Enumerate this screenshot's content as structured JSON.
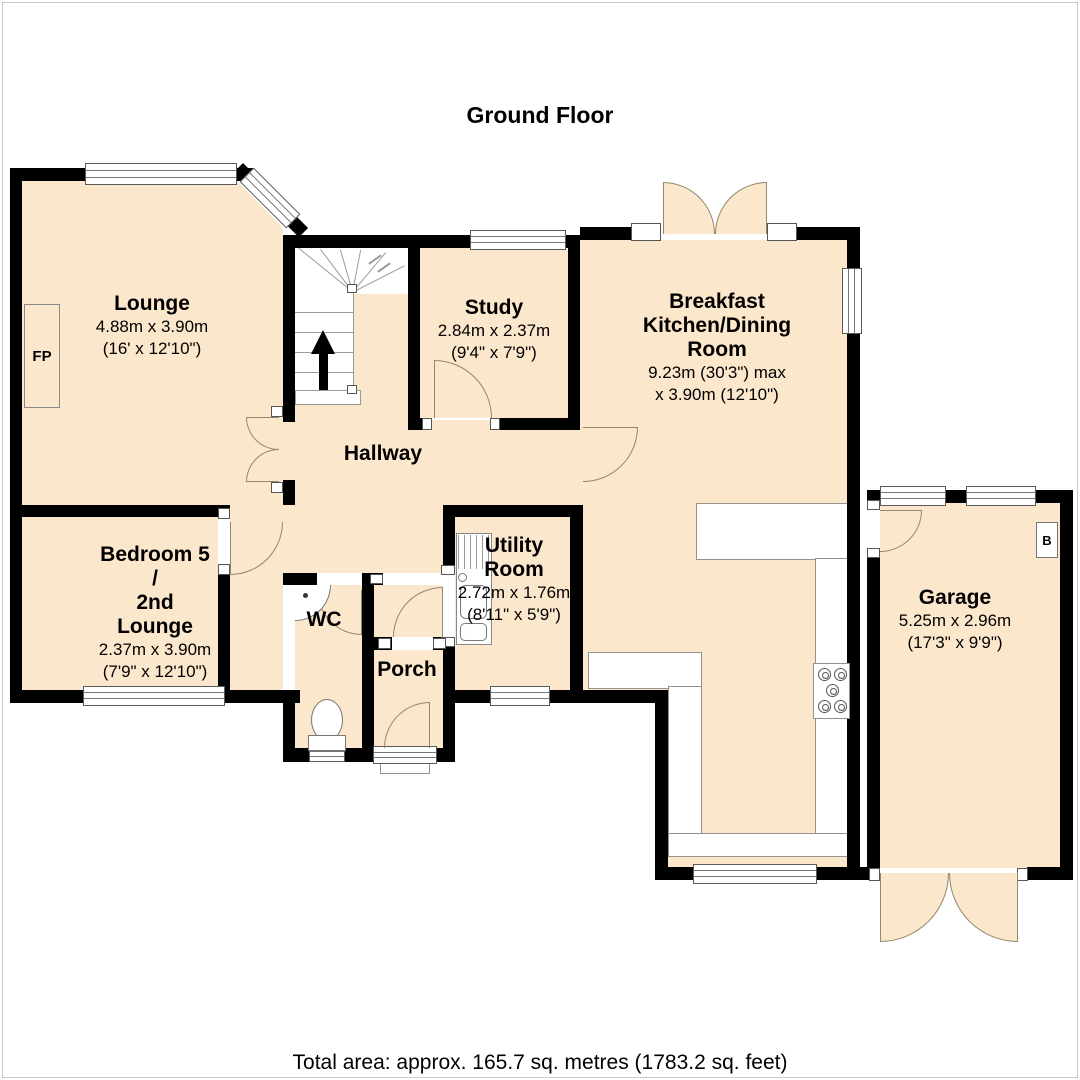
{
  "title": "Ground Floor",
  "footer": "Total area: approx. 165.7 sq. metres (1783.2 sq. feet)",
  "rooms": {
    "lounge": {
      "name": "Lounge",
      "dim_m": "4.88m x 3.90m",
      "dim_ft": "(16' x 12'10\")"
    },
    "study": {
      "name": "Study",
      "dim_m": "2.84m x 2.37m",
      "dim_ft": "(9'4\" x 7'9\")"
    },
    "kitchen": {
      "line1": "Breakfast",
      "line2": "Kitchen/Dining",
      "line3": "Room",
      "dim1": "9.23m (30'3\") max",
      "dim2": "x 3.90m (12'10\")"
    },
    "hallway": {
      "name": "Hallway"
    },
    "bedroom5": {
      "line1": "Bedroom 5",
      "line2": "/",
      "line3": "2nd",
      "line4": "Lounge",
      "dim_m": "2.37m x 3.90m",
      "dim_ft": "(7'9\" x 12'10\")"
    },
    "wc": {
      "name": "WC"
    },
    "porch": {
      "name": "Porch"
    },
    "utility": {
      "line1": "Utility",
      "line2": "Room",
      "dim_m": "2.72m x 1.76m",
      "dim_ft": "(8'11\" x 5'9\")"
    },
    "garage": {
      "name": "Garage",
      "dim_m": "5.25m x 2.96m",
      "dim_ft": "(17'3\" x 9'9\")"
    }
  },
  "markers": {
    "fireplace": "FP",
    "boiler": "B"
  },
  "colors": {
    "floor": "#fbe7cb",
    "wall": "#000000"
  }
}
